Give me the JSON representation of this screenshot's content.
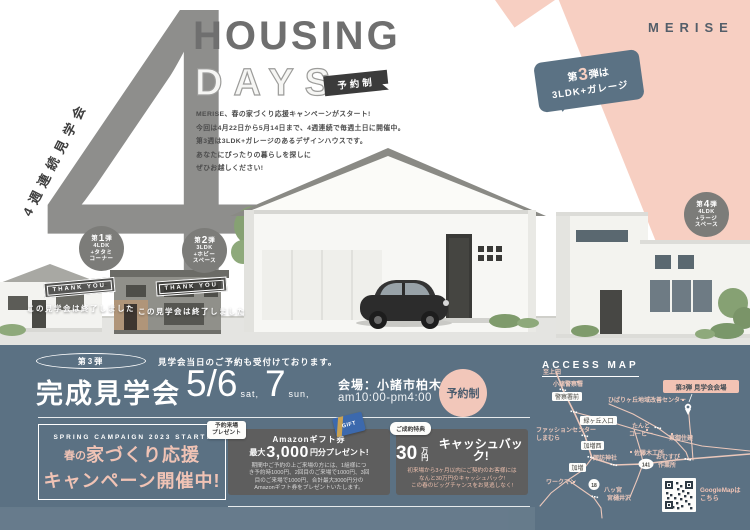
{
  "colors": {
    "slate": "#5b7183",
    "pink": "#f7cfc2",
    "salmon": "#f0c3b5",
    "title_gray": "#6f6f6f",
    "badge_dark": "#3b3b3b",
    "circle_gray": "#7c7c79",
    "box_gray": "#5e5e5e"
  },
  "header": {
    "logo": "MERISE",
    "weeks_label": "4週連続見学会",
    "big_number": "4",
    "title1": "HOUSING",
    "title2": "DAYS",
    "reserved_badge": "予約制",
    "intro": [
      "MERISE、春の家づくり応援キャンペーンがスタート!",
      "今回は4月22日から5月14日まで、4週連続で毎週土日に開催中。",
      "第3週は3LDK+ガレージのあるデザインハウスです。",
      "あなたにぴったりの暮らしを探しに",
      "ぜひお越しください!"
    ],
    "bubble_prefix": "第",
    "bubble_num": "3",
    "bubble_suffix": "弾は",
    "bubble_line2": "3LDK+ガレージ"
  },
  "houses": {
    "circles": [
      {
        "prefix": "第",
        "num": "1",
        "suffix": "弾",
        "l1": "4LDK",
        "l2": "+タタミ",
        "l3": "コーナー"
      },
      {
        "prefix": "第",
        "num": "2",
        "suffix": "弾",
        "l1": "3LDK",
        "l2": "+ホビー",
        "l3": "スペース"
      },
      {
        "prefix": "第",
        "num": "4",
        "suffix": "弾",
        "l1": "4LDK",
        "l2": "+ラージ",
        "l3": "スペース"
      }
    ],
    "thank_you": "THANK YOU",
    "ended_note": "この見学会は終了しました"
  },
  "event": {
    "stage": "第3弾",
    "same_day_note": "見学会当日のご予約も受付けております。",
    "title": "完成見学会",
    "date1": "5/6",
    "date1_day": "sat,",
    "date2": "7",
    "date2_day": "sun,",
    "venue": "会場：小諸市柏木",
    "time": "am10:00-pm4:00",
    "reserved": "予約制"
  },
  "campaign": {
    "eyebrow": "SPRING CAMPAIGN 2023 START!",
    "line1_small": "春の",
    "line1_big": "家づくり応援",
    "line2": "キャンペーン開催中!"
  },
  "gift": {
    "tab1": "予約来場",
    "tab2": "プレゼント",
    "card_label": "GIFT",
    "heading": "Amazonギフト券",
    "max": "最大",
    "amount": "3,000",
    "suffix": "円分プレゼント!",
    "detail": [
      "期間中ご予約の上ご来場の方には、1組様につ",
      "き予約時1000円、2回目のご来場で1000円、3回",
      "目のご来場で1000円、合計最大3000円分の",
      "Amazonギフト券をプレゼントいたします。"
    ]
  },
  "cashback": {
    "tab": "ご成約特典",
    "amount": "30",
    "unit": "万円",
    "label": "キャッシュバック!",
    "detail": [
      "初来場から3ヶ月以内にご契約のお客様には",
      "なんと30万円のキャッシュバック!",
      "この春のビッグチャンスをお見逃しなく!"
    ]
  },
  "map": {
    "title": "ACCESS MAP",
    "venue_badge": "第3弾 見学会会場",
    "to_ueda": "至上田",
    "police_station": "小諸警察署",
    "police_front": "警察署前",
    "midorigaoka": "緑ヶ丘入口",
    "fashion_center": "ファッションセンター",
    "shimamura": "しまむら",
    "kamasu_nishi": "加増西",
    "suwa_shrine": "諏訪神社",
    "kamasu": "加増",
    "workman": "ワークマン",
    "route18": "18",
    "yatsumiya": "八ッ宮",
    "miyahiisawa": "宮樋井沢",
    "hibarigaoka": "ひばりヶ丘地域改善センター",
    "tanto1": "たんと",
    "tanto2": "コーヒー",
    "sato_woodworks": "佐藤木工所",
    "tomi_juken": "東御住建",
    "route141": "141",
    "omusubi1": "おむすび",
    "omusubi2": "作業所",
    "qr_caption_1": "GoogleMapは",
    "qr_caption_2": "こちら"
  }
}
